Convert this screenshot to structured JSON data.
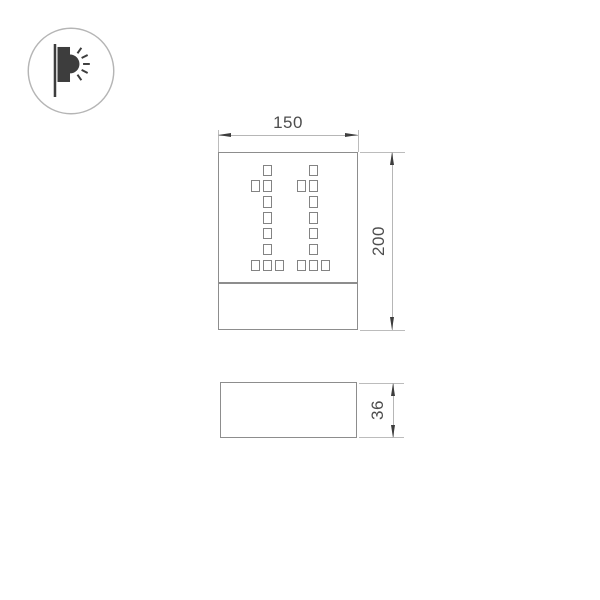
{
  "logo": {
    "icon": "wall-light-icon"
  },
  "views": {
    "front": {
      "name": "front view",
      "width_label": "150",
      "height_label": "200",
      "perforation_pattern": [
        ".X.",
        "XX.",
        ".X.",
        ".X.",
        ".X.",
        ".X.",
        "XXX"
      ],
      "digit_count": 2
    },
    "side": {
      "name": "side view",
      "depth_label": "36"
    }
  },
  "colors": {
    "outline": "#8d8d8d",
    "perforation_outline": "#838383",
    "dimension_line": "#b6b6b6",
    "arrow": "#3d3d3d",
    "text": "#4d4d4d",
    "logo_glyph": "#3d3d3d",
    "logo_circle": "#b5b5b5",
    "background": "#ffffff"
  }
}
